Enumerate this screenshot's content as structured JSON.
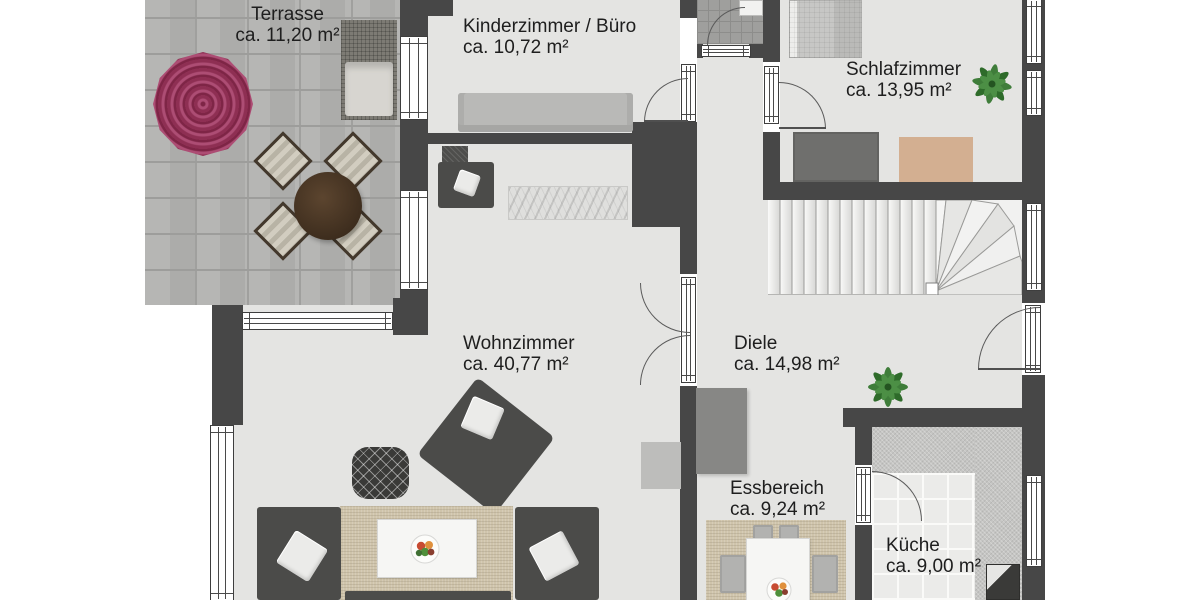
{
  "plan": {
    "title": "Grundriss / floor plan",
    "unit": "m²",
    "rooms": {
      "terrasse": {
        "name": "Terrasse",
        "area": "ca. 11,20 m²"
      },
      "kinderzimmer": {
        "name": "Kinderzimmer / Büro",
        "area": "ca. 10,72 m²"
      },
      "schlafzimmer": {
        "name": "Schlafzimmer",
        "area": "ca. 13,95 m²"
      },
      "wohnzimmer": {
        "name": "Wohnzimmer",
        "area": "ca. 40,77 m²"
      },
      "diele": {
        "name": "Diele",
        "area": "ca. 14,98 m²"
      },
      "essbereich": {
        "name": "Essbereich",
        "area": "ca. 9,24 m²"
      },
      "kueche": {
        "name": "Küche",
        "area": "ca. 9,00 m²"
      }
    },
    "colors": {
      "wall": "#474747",
      "floor": "#e4e4e2",
      "terrace_paving": "#b2b2b0",
      "umbrella_accent": "#8e2f53",
      "plant_green": "#3f7d3a",
      "text": "#1e1e1e"
    }
  }
}
